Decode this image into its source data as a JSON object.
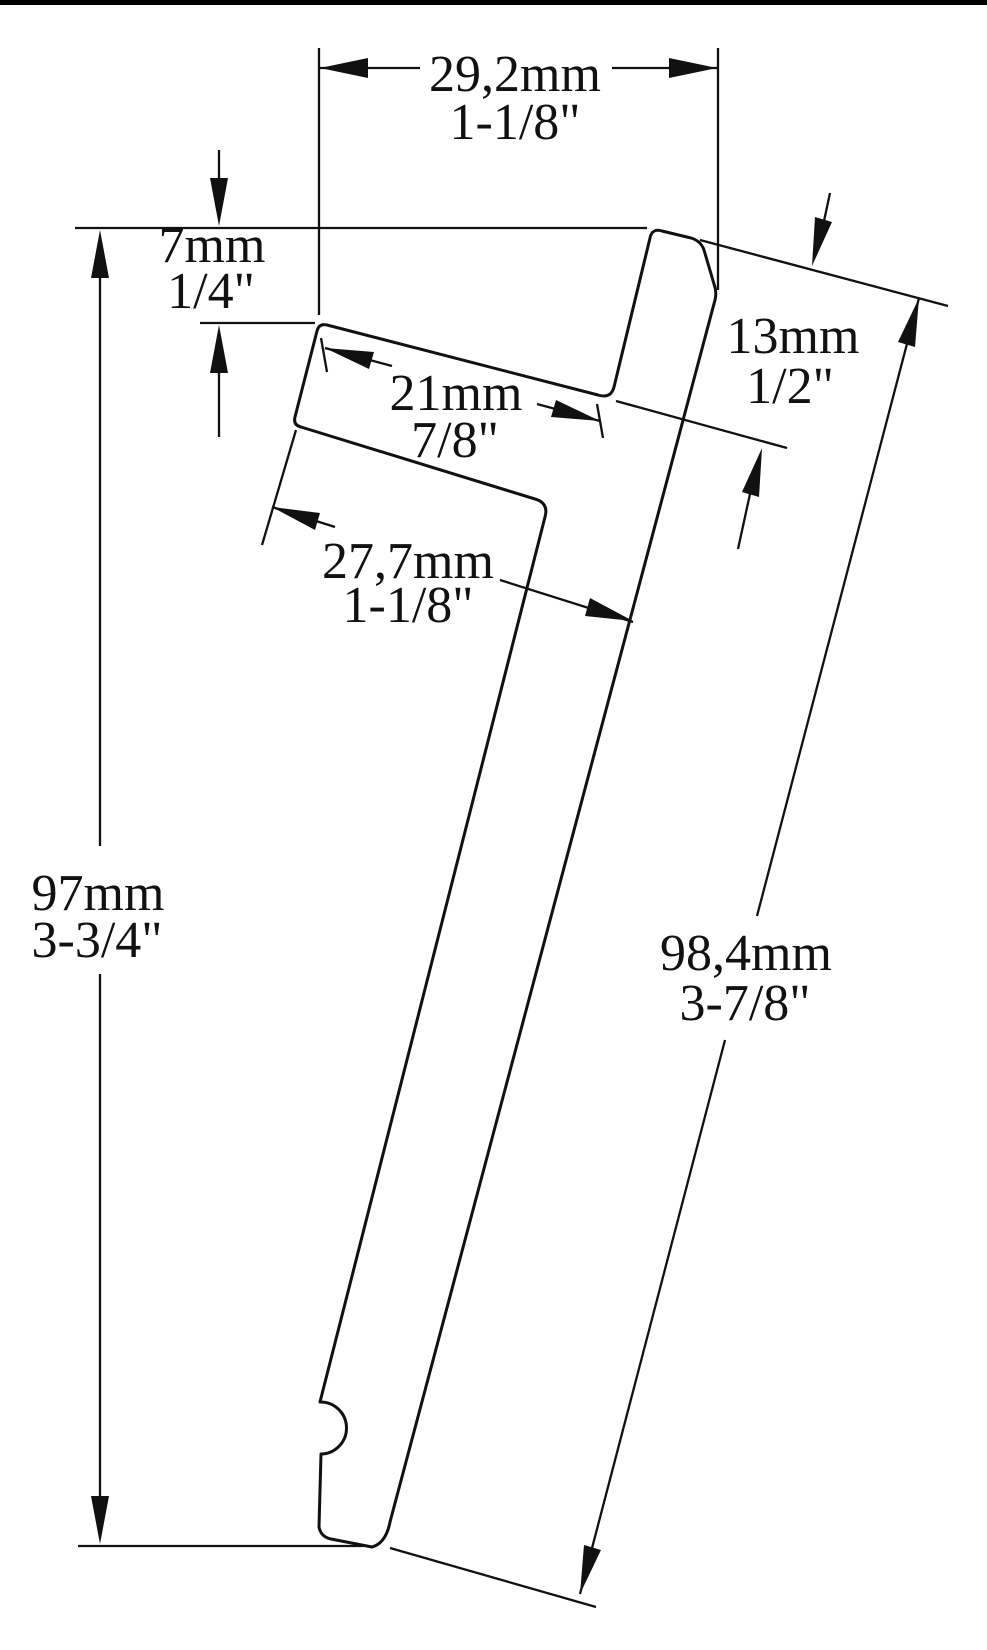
{
  "page": {
    "background": "#ffffff",
    "line_color": "#111111",
    "description": "Technical cross-section drawing of a tilted J-shaped trim profile with dimension callouts"
  },
  "dimensions": {
    "overall_width": {
      "metric": "29,2mm",
      "imperial": "1-1/8\""
    },
    "top_offset": {
      "metric": "7mm",
      "imperial": "1/4\""
    },
    "leg_protrusion": {
      "metric": "13mm",
      "imperial": "1/2\""
    },
    "channel_width": {
      "metric": "21mm",
      "imperial": "7/8\""
    },
    "lower_depth": {
      "metric": "27,7mm",
      "imperial": "1-1/8\""
    },
    "overall_height": {
      "metric": "97mm",
      "imperial": "3-3/4\""
    },
    "leg_length": {
      "metric": "98,4mm",
      "imperial": "3-7/8\""
    }
  }
}
